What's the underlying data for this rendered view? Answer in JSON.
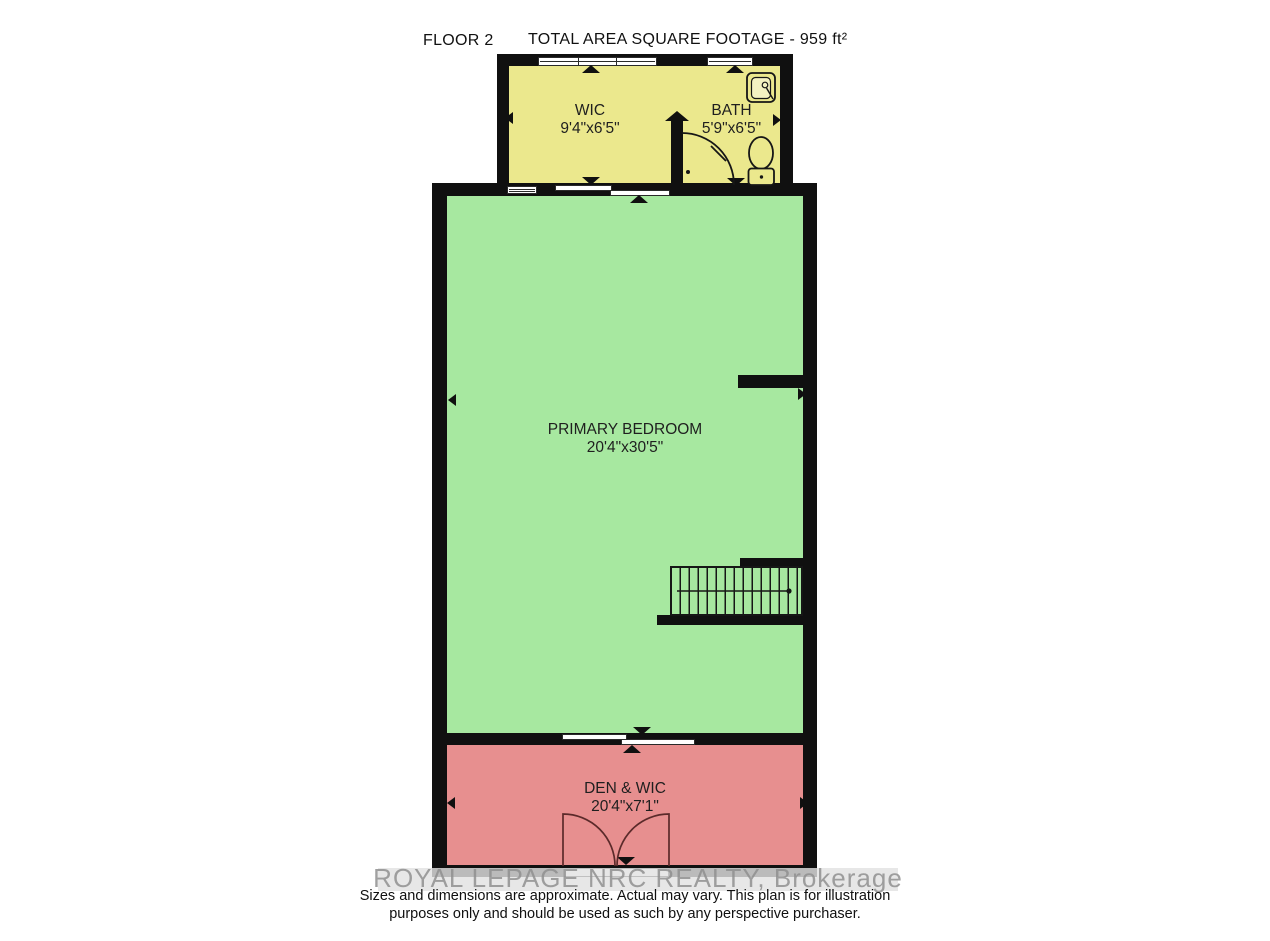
{
  "header": {
    "floor_label": "FLOOR 2",
    "total_area_label": "TOTAL AREA SQUARE FOOTAGE - 959 ft²"
  },
  "rooms": {
    "wic": {
      "name": "WIC",
      "dims": "9'4\"x6'5\""
    },
    "bath": {
      "name": "BATH",
      "dims": "5'9\"x6'5\""
    },
    "primary_bedroom": {
      "name": "PRIMARY BEDROOM",
      "dims": "20'4\"x30'5\""
    },
    "den_wic": {
      "name": "DEN & WIC",
      "dims": "20'4\"x7'1\""
    }
  },
  "watermark": {
    "text": "ROYAL LEPAGE NRC REALTY, Brokerage"
  },
  "disclaimer": {
    "line1": "Sizes and dimensions are approximate. Actual may vary. This plan is for illustration",
    "line2": "purposes only and should be used as such by any perspective purchaser."
  },
  "colors": {
    "wall": "#101010",
    "closet_fill": "#ebe88d",
    "bedroom_fill": "#a7e8a0",
    "den_fill": "#e78f8f",
    "window_fill": "#ffffff",
    "door_arc": "#5b2a2a",
    "watermark_band": "rgba(226,226,226,0.82)",
    "watermark_text": "rgba(143,143,143,0.85)"
  }
}
